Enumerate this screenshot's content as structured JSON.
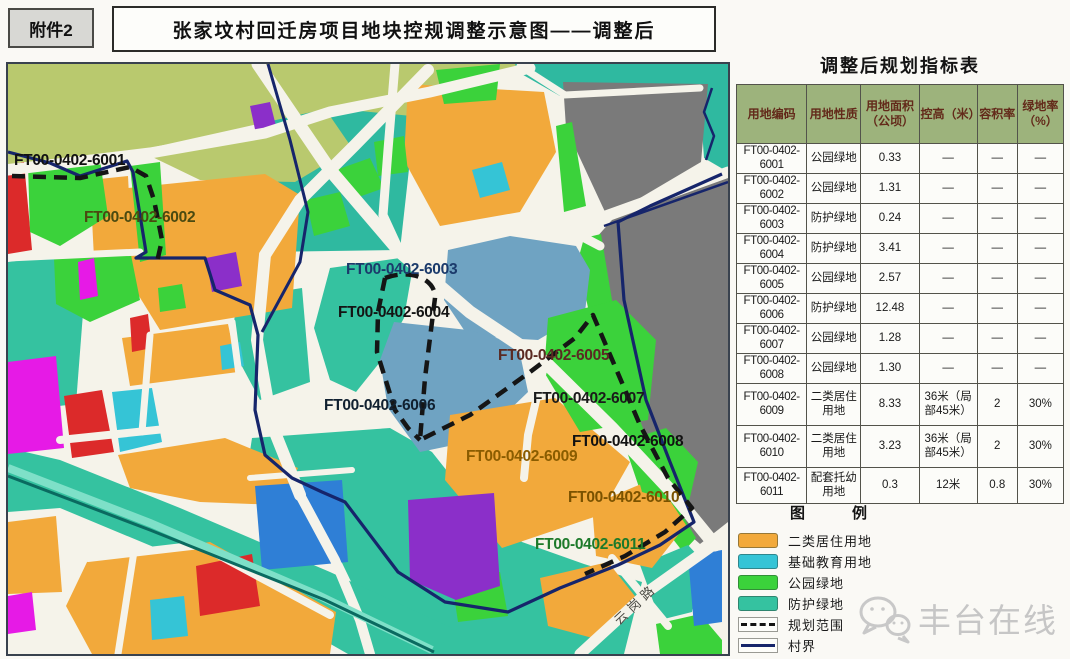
{
  "header": {
    "attachment": "附件2",
    "title": "张家坟村回迁房项目地块控规调整示意图——调整后"
  },
  "table": {
    "title": "调整后规划指标表",
    "columns": [
      "用地编码",
      "用地性质",
      "用地面积（公顷）",
      "控高（米）",
      "容积率",
      "绿地率（%）"
    ],
    "rows": [
      {
        "code": "FT00-0402-",
        "num": "6001",
        "use": "公园绿地",
        "area": "0.33",
        "height": "—",
        "far": "—",
        "green": "—"
      },
      {
        "code": "FT00-0402-",
        "num": "6002",
        "use": "公园绿地",
        "area": "1.31",
        "height": "—",
        "far": "—",
        "green": "—"
      },
      {
        "code": "FT00-0402-",
        "num": "6003",
        "use": "防护绿地",
        "area": "0.24",
        "height": "—",
        "far": "—",
        "green": "—"
      },
      {
        "code": "FT00-0402-",
        "num": "6004",
        "use": "防护绿地",
        "area": "3.41",
        "height": "—",
        "far": "—",
        "green": "—"
      },
      {
        "code": "FT00-0402-",
        "num": "6005",
        "use": "公园绿地",
        "area": "2.57",
        "height": "—",
        "far": "—",
        "green": "—"
      },
      {
        "code": "FT00-0402-",
        "num": "6006",
        "use": "防护绿地",
        "area": "12.48",
        "height": "—",
        "far": "—",
        "green": "—"
      },
      {
        "code": "FT00-0402-",
        "num": "6007",
        "use": "公园绿地",
        "area": "1.28",
        "height": "—",
        "far": "—",
        "green": "—"
      },
      {
        "code": "FT00-0402-",
        "num": "6008",
        "use": "公园绿地",
        "area": "1.30",
        "height": "—",
        "far": "—",
        "green": "—"
      },
      {
        "code": "FT00-0402-",
        "num": "6009",
        "use": "二类居住用地",
        "area": "8.33",
        "height": "36米（局部45米）",
        "far": "2",
        "green": "30%"
      },
      {
        "code": "FT00-0402-",
        "num": "6010",
        "use": "二类居住用地",
        "area": "3.23",
        "height": "36米（局部45米）",
        "far": "2",
        "green": "30%"
      },
      {
        "code": "FT00-0402-",
        "num": "6011",
        "use": "配套托幼用地",
        "area": "0.3",
        "height": "12米",
        "far": "0.8",
        "green": "30%"
      }
    ]
  },
  "legend": {
    "title": "图　例",
    "items": [
      {
        "label": "二类居住用地",
        "swatch": "residential"
      },
      {
        "label": "基础教育用地",
        "swatch": "education"
      },
      {
        "label": "公园绿地",
        "swatch": "park"
      },
      {
        "label": "防护绿地",
        "swatch": "protective"
      },
      {
        "label": "规划范围",
        "swatch": "dashed-line"
      },
      {
        "label": "村界",
        "swatch": "solid-line"
      }
    ]
  },
  "map": {
    "palette": {
      "road": "#F5F3EA",
      "olive": "#B9C96E",
      "teal_region": "#2FB9A0",
      "protective": "#35C2A0",
      "park": "#3BD23B",
      "residential": "#F2A93B",
      "education": "#35C4D6",
      "gray": "#7A7A7A",
      "steel": "#6FA3C2",
      "blue": "#2F7FD6",
      "magenta": "#E61AE6",
      "purple": "#8B2FC9",
      "red": "#DC2A2A",
      "boundary_dash": "#151515",
      "village": "#16256B",
      "river": "#0A6A60",
      "band_stripe": "#7EE0C8",
      "table_header": "#9DB37C",
      "table_header_text": "#632A1A"
    },
    "plot_labels": [
      {
        "text": "FT00-0402-6001",
        "color": "#111111"
      },
      {
        "text": "FT00-0402-6002",
        "color": "#4A4A10"
      },
      {
        "text": "FT00-0402-6003",
        "color": "#1B3A6B"
      },
      {
        "text": "FT00-0402-6004",
        "color": "#141414"
      },
      {
        "text": "FT00-0402-6005",
        "color": "#5A2A22"
      },
      {
        "text": "FT00-0402-6006",
        "color": "#102030"
      },
      {
        "text": "FT00-0402-6007",
        "color": "#1A1A1A"
      },
      {
        "text": "FT00-0402-6008",
        "color": "#111111"
      },
      {
        "text": "FT00-0402-6009",
        "color": "#8A5C00"
      },
      {
        "text": "FT00-0402-6010",
        "color": "#7A5200"
      },
      {
        "text": "FT00-0402-6011",
        "color": "#1D7A2A"
      }
    ],
    "road_labels": [
      {
        "text": "云岗路"
      }
    ]
  },
  "watermark": {
    "text": "丰台在线"
  }
}
